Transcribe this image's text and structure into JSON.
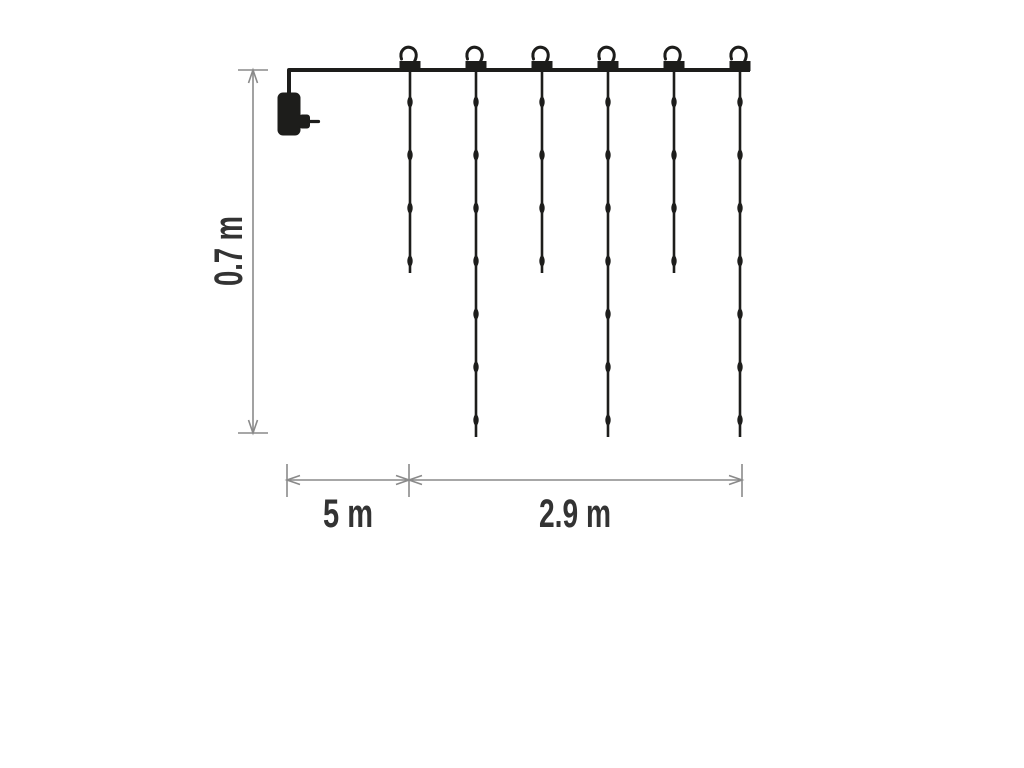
{
  "diagram": {
    "description": "icicle light curtain dimension diagram",
    "colors": {
      "background": "#ffffff",
      "ink": "#1d1d1b",
      "dimension_line": "#8a8a8a",
      "label_text": "#333333"
    },
    "wire": {
      "y": 70,
      "x_start": 289,
      "x_end": 750,
      "drop_x": 289,
      "drop_to_y": 93
    },
    "plug": {
      "name": "power-plug",
      "body": [
        277.5,
        92.5,
        23,
        43
      ],
      "nub": [
        299,
        114.5,
        11,
        14
      ],
      "pin": [
        309,
        121.5,
        318.5,
        121.5
      ]
    },
    "led_start_y": 102,
    "led_spacing": 53,
    "strands": [
      {
        "x": 410,
        "leds": 4,
        "end_y": 273
      },
      {
        "x": 476,
        "leds": 7,
        "end_y": 437
      },
      {
        "x": 542,
        "leds": 4,
        "end_y": 273
      },
      {
        "x": 608,
        "leds": 7,
        "end_y": 437
      },
      {
        "x": 674,
        "leds": 4,
        "end_y": 273
      },
      {
        "x": 740,
        "leds": 7,
        "end_y": 437
      }
    ],
    "dimensions": {
      "height": {
        "label": "0.7 m",
        "axis": "vertical",
        "x": 253,
        "from_y": 70,
        "to_y": 433,
        "tick_x1": 238,
        "tick_x2": 268,
        "label_x": 242,
        "label_y": 251
      },
      "lead": {
        "label": "5 m",
        "axis": "horizontal",
        "y": 480,
        "from_x": 287,
        "to_x": 409,
        "label_x": 348,
        "label_y": 527
      },
      "width": {
        "label": "2.9 m",
        "axis": "horizontal",
        "y": 480,
        "from_x": 409,
        "to_x": 742,
        "label_x": 575,
        "label_y": 527
      },
      "h_tick_y1": 464,
      "h_tick_y2": 497
    }
  }
}
